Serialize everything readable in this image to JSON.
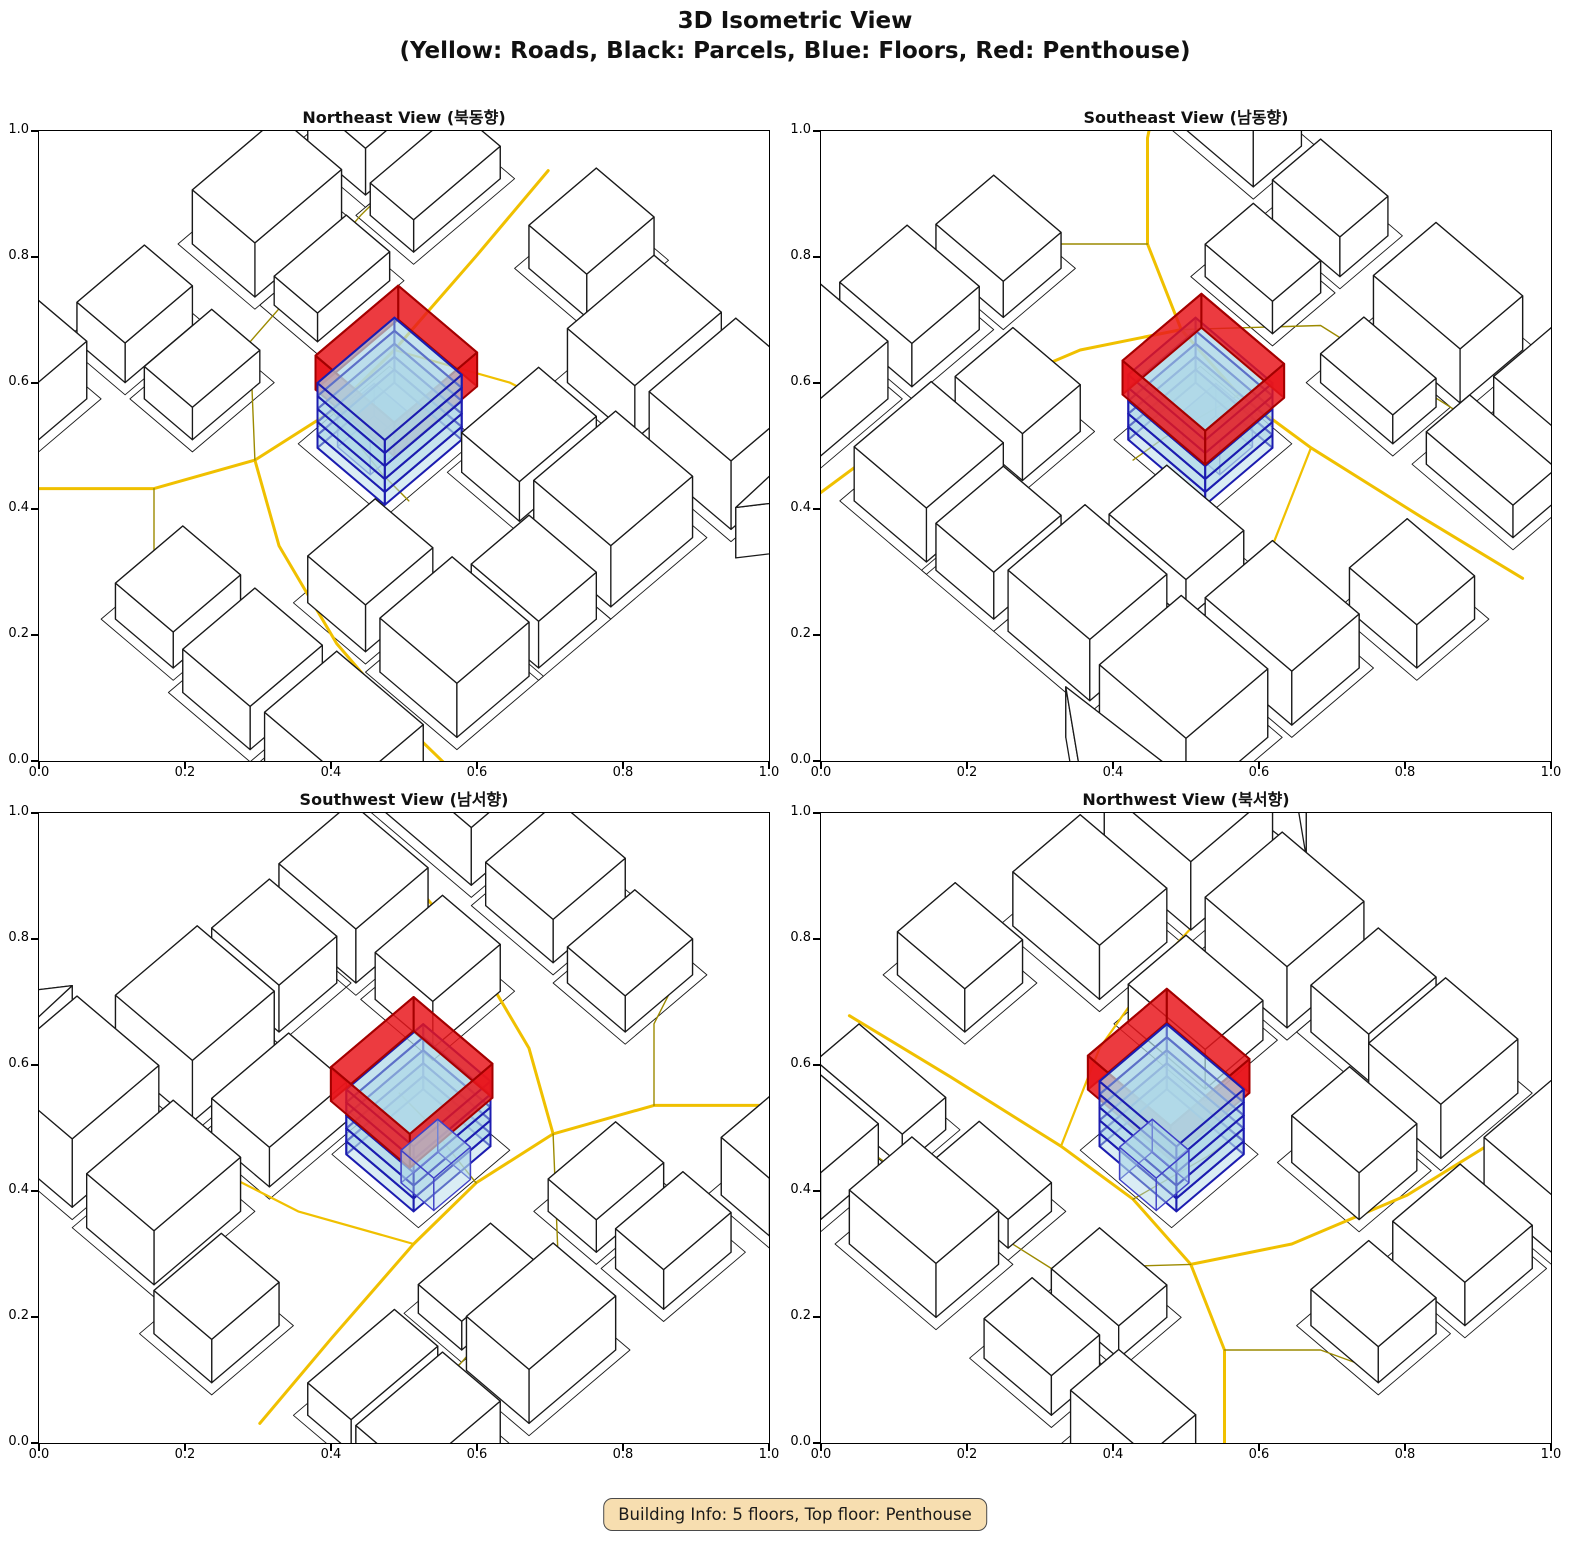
{
  "figure": {
    "title_line1": "3D Isometric View",
    "title_line2": "(Yellow: Roads, Black: Parcels, Blue: Floors, Red: Penthouse)"
  },
  "panels": [
    {
      "id": "northeast",
      "title": "Northeast View (북동향)",
      "azimuth_deg": 45
    },
    {
      "id": "southeast",
      "title": "Southeast View (남동향)",
      "azimuth_deg": 135
    },
    {
      "id": "southwest",
      "title": "Southwest View (남서향)",
      "azimuth_deg": 225
    },
    {
      "id": "northwest",
      "title": "Northwest View (북서향)",
      "azimuth_deg": 315
    }
  ],
  "axis": {
    "ticks": [
      "0.0",
      "0.2",
      "0.4",
      "0.6",
      "0.8",
      "1.0"
    ],
    "range": [
      0,
      1
    ]
  },
  "info_box": {
    "text": "Building Info: 5 floors, Top floor: Penthouse"
  },
  "colors": {
    "road_primary": "#F0C000",
    "road_secondary": "#9C8A00",
    "parcel_edge": "#1a1a1a",
    "building_fill": "#ffffff",
    "building_edge": "#1a1a1a",
    "floor_fill": "rgba(173,216,230,0.45)",
    "floor_edge": "#1C1CB0",
    "annex_edge": "#4040C8",
    "penthouse_fill": "rgba(232,22,28,0.84)",
    "penthouse_edge": "#A40000",
    "info_bg": "#f7deb0"
  },
  "chart_data": {
    "type": "3d-isometric-views",
    "title": "3D Isometric View",
    "subtitle": "(Yellow: Roads, Black: Parcels, Blue: Floors, Red: Penthouse)",
    "views": [
      "Northeast View (북동향)",
      "Southeast View (남동향)",
      "Southwest View (남서향)",
      "Northwest View (북서향)"
    ],
    "building_info": {
      "floors": 5,
      "top_floor": "Penthouse"
    },
    "camera": {
      "elevation_deg": 58,
      "azimuths_deg": [
        45,
        135,
        225,
        315
      ]
    },
    "axis_range": [
      0,
      1
    ],
    "grid": false,
    "scene": {
      "parcel_margin": 0.015,
      "central_parcel": [
        0.405,
        0.375,
        0.595,
        0.555
      ],
      "roads": [
        {
          "color_key": "road_primary",
          "width": 3,
          "points": [
            [
              0.0,
              0.3
            ],
            [
              0.18,
              0.33
            ],
            [
              0.38,
              0.36
            ],
            [
              0.52,
              0.37
            ],
            [
              0.66,
              0.35
            ],
            [
              0.8,
              0.28
            ],
            [
              0.93,
              0.15
            ],
            [
              1.0,
              0.05
            ]
          ]
        },
        {
          "color_key": "road_primary",
          "width": 3,
          "points": [
            [
              0.66,
              0.35
            ],
            [
              0.74,
              0.48
            ],
            [
              0.8,
              0.66
            ],
            [
              0.83,
              0.85
            ],
            [
              0.84,
              1.0
            ]
          ]
        },
        {
          "color_key": "road_primary",
          "width": 2.2,
          "points": [
            [
              0.38,
              0.36
            ],
            [
              0.3,
              0.52
            ],
            [
              0.255,
              0.7
            ],
            [
              0.235,
              0.88
            ],
            [
              0.23,
              1.0
            ]
          ]
        },
        {
          "color_key": "road_secondary",
          "width": 1.4,
          "points": [
            [
              0.0,
              0.14
            ],
            [
              0.25,
              0.16
            ],
            [
              0.52,
              0.2
            ],
            [
              0.66,
              0.35
            ]
          ]
        },
        {
          "color_key": "road_secondary",
          "width": 1.4,
          "points": [
            [
              0.52,
              0.37
            ],
            [
              0.545,
              0.5
            ],
            [
              0.55,
              0.56
            ]
          ]
        },
        {
          "color_key": "road_secondary",
          "width": 1.4,
          "points": [
            [
              0.8,
              0.28
            ],
            [
              0.9,
              0.38
            ],
            [
              1.0,
              0.42
            ]
          ]
        }
      ],
      "buildings": [
        {
          "rect": [
            0.07,
            0.76,
            0.25,
            0.93
          ],
          "height": 0.19
        },
        {
          "rect": [
            0.3,
            0.74,
            0.47,
            0.9
          ],
          "height": 0.17
        },
        {
          "rect": [
            0.5,
            0.76,
            0.62,
            0.9
          ],
          "height": 0.13
        },
        {
          "rect": [
            0.64,
            0.74,
            0.79,
            0.9
          ],
          "height": 0.15
        },
        {
          "rect": [
            0.88,
            0.74,
            1.03,
            0.92
          ],
          "height": 0.16
        },
        {
          "rect": [
            0.06,
            0.58,
            0.24,
            0.72
          ],
          "height": 0.15
        },
        {
          "rect": [
            0.3,
            0.58,
            0.46,
            0.7
          ],
          "height": 0.11
        },
        {
          "rect": [
            0.64,
            0.58,
            0.78,
            0.7
          ],
          "height": 0.13
        },
        {
          "rect": [
            0.87,
            0.56,
            1.02,
            0.7
          ],
          "height": 0.12
        },
        {
          "rect": [
            0.04,
            0.02,
            0.22,
            0.14
          ],
          "height": 0.13
        },
        {
          "rect": [
            0.06,
            0.17,
            0.24,
            0.26
          ],
          "height": 0.09
        },
        {
          "rect": [
            0.28,
            0.02,
            0.46,
            0.15
          ],
          "height": 0.15
        },
        {
          "rect": [
            0.3,
            0.18,
            0.45,
            0.27
          ],
          "height": 0.08
        },
        {
          "rect": [
            0.56,
            0.02,
            0.7,
            0.12
          ],
          "height": 0.11
        },
        {
          "rect": [
            0.56,
            0.16,
            0.7,
            0.26
          ],
          "height": 0.09
        },
        {
          "rect": [
            0.76,
            0.0,
            0.92,
            0.1
          ],
          "height": 0.16
        },
        {
          "rect": [
            0.86,
            0.4,
            1.0,
            0.52
          ],
          "height": 0.1
        },
        {
          "rect": [
            0.0,
            0.4,
            0.14,
            0.52
          ],
          "height": 0.12
        }
      ],
      "poly_buildings": [
        {
          "poly": [
            [
              0.06,
              0.96
            ],
            [
              0.28,
              0.97
            ],
            [
              0.16,
              1.06
            ]
          ],
          "height": 0.14
        }
      ],
      "central_building": {
        "footprint": [
          0.42,
          0.4,
          0.58,
          0.54
        ],
        "floors": 5,
        "floor_height": 0.036,
        "annex": {
          "rect": [
            0.462,
            0.4,
            0.538,
            0.468
          ],
          "z": [
            -0.045,
            0.045
          ]
        },
        "penthouse": {
          "rect": [
            0.404,
            0.392,
            0.576,
            0.556
          ],
          "z": [
            0.148,
            0.242
          ],
          "open_top": true
        }
      }
    }
  }
}
